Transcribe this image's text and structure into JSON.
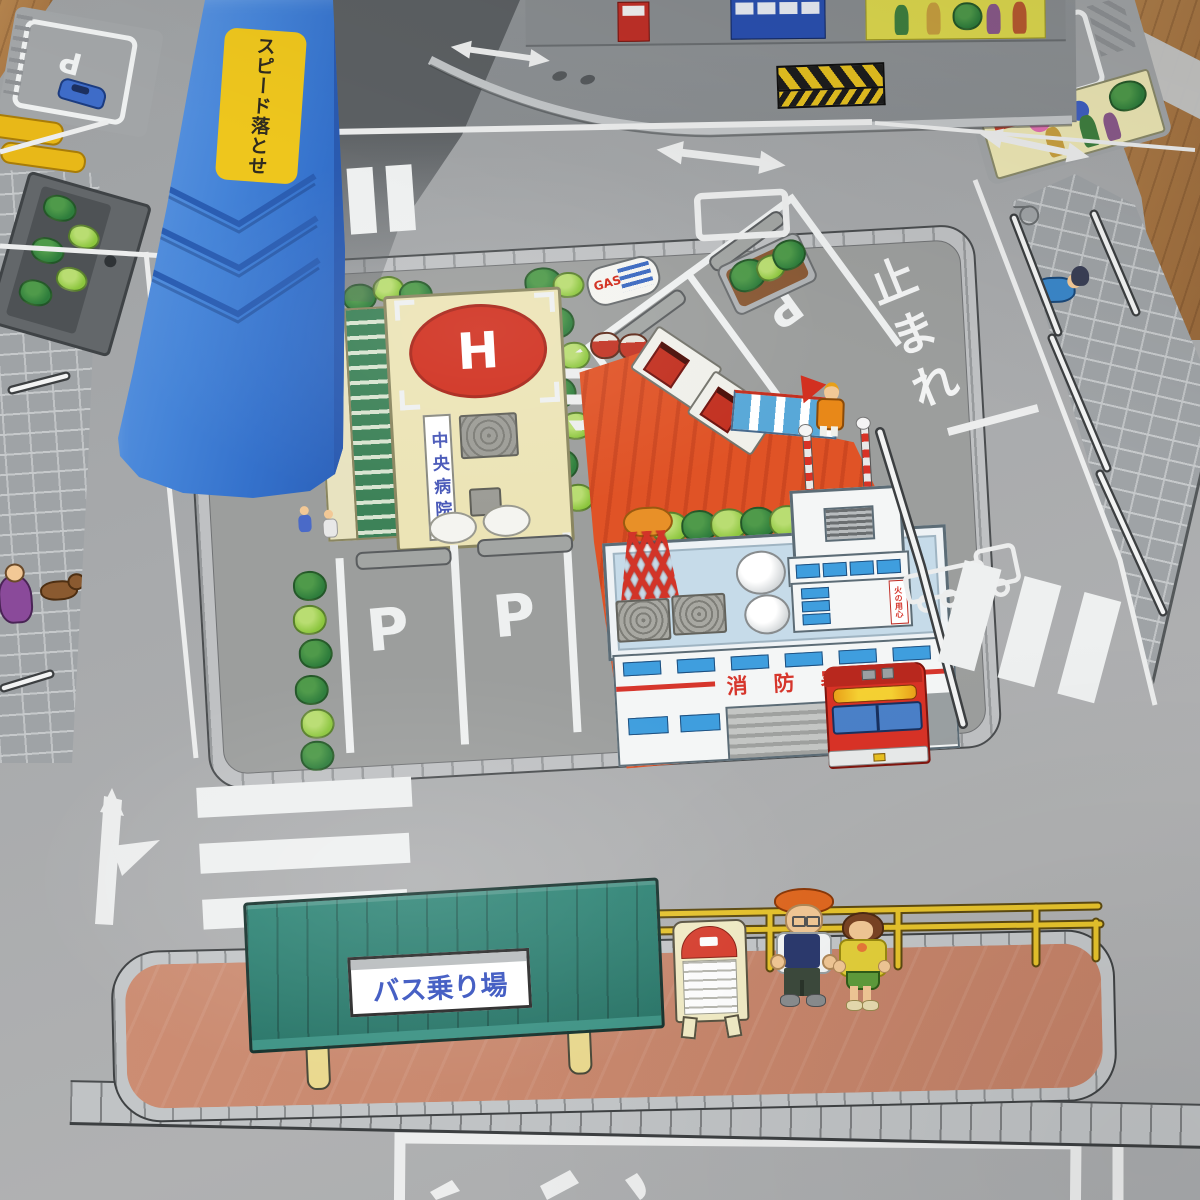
{
  "scene": {
    "description": "Toy town road playmat (photo) with hospital, gas stand, fire station and bus stop",
    "ramp": {
      "warning_sign": "スピード落とせ"
    },
    "road": {
      "stop_marking": "止まれ",
      "parking_letter": "P"
    },
    "hospital": {
      "name": "中央病院",
      "helipad_letter": "H"
    },
    "gas_station": {
      "name": "GAS STAND",
      "tank_label": "GAS"
    },
    "fire_station": {
      "name": "消防署",
      "caution_sign": "火の用心"
    },
    "bus_stop": {
      "sign": "バス乗り場"
    },
    "sidewalk": {
      "hydrant_marker": "消火栓"
    },
    "colors": {
      "ramp_blue": "#3f7bd0",
      "sticker_yellow": "#eec61d",
      "road_gray": "#a5a7a9",
      "plastic_gray": "#8f9396",
      "hospital_cream": "#ece4b6",
      "helipad_red": "#d0301f",
      "gas_canopy_red": "#dd4f24",
      "fire_roof_blue": "#c6dbe9",
      "fire_red": "#d23428",
      "shelter_green": "#2d7f71",
      "platform_salmon": "#c8876e",
      "guardrail_yellow": "#e6c32c",
      "wood_floor": "#ad7b48"
    }
  }
}
